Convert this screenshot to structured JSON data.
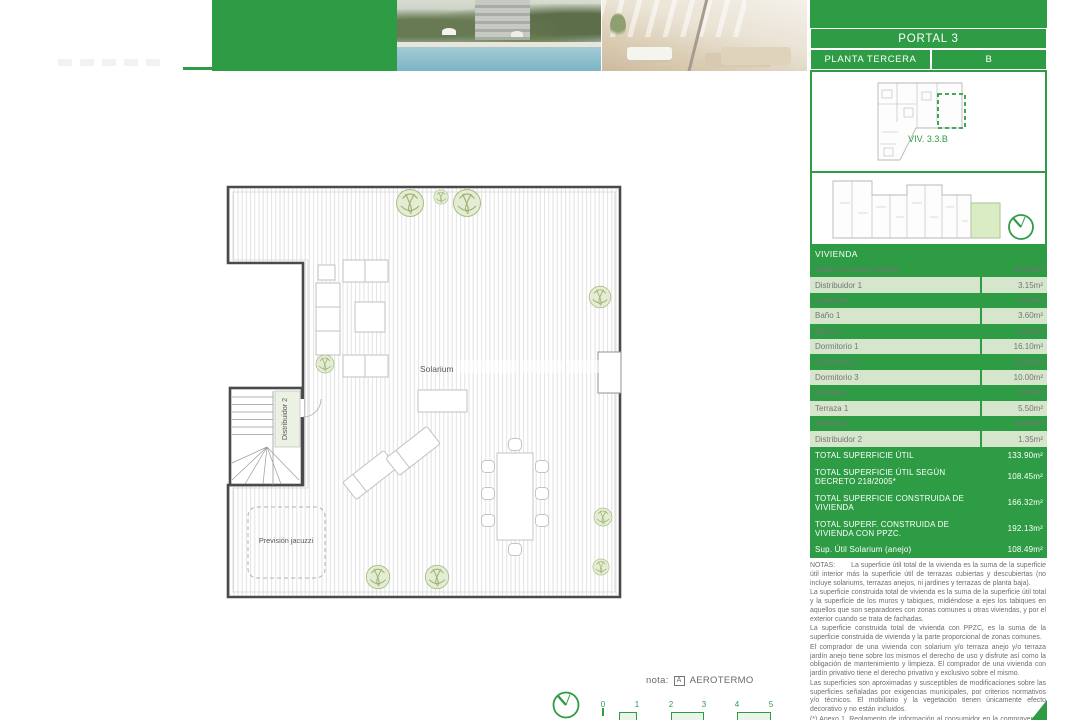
{
  "colors": {
    "green": "#2E9C45",
    "row_green": "#D6E6CC",
    "unit_highlight": "#D9ECC3"
  },
  "header": {
    "portal": "PORTAL 3",
    "floor": "PLANTA TERCERA",
    "unit": "B"
  },
  "keyplan": {
    "label": "VIV. 3.3.B"
  },
  "plan": {
    "solarium_label": "Solarium",
    "stair_label": "Distribuidor 2",
    "jacuzzi_label": "Previsión jacuzzi"
  },
  "table": {
    "header": "VIVIENDA",
    "rows": [
      {
        "name": "Salón-Comedor-Cocina",
        "value": "42.35m²"
      },
      {
        "name": "Distribuidor 1",
        "value": "3.15m²"
      },
      {
        "name": "Lavadero",
        "value": "4.45m²"
      },
      {
        "name": "Baño 1",
        "value": "3.60m²"
      },
      {
        "name": "Baño 2",
        "value": "4.30m²"
      },
      {
        "name": "Dormitorio 1",
        "value": "16.10m²"
      },
      {
        "name": "Dormitorio 2",
        "value": "10.05m²"
      },
      {
        "name": "Dormitorio 3",
        "value": "10.00m²"
      },
      {
        "name": "Escalera",
        "value": "3.00m²"
      },
      {
        "name": "Terraza 1",
        "value": "5.50m²"
      },
      {
        "name": "Terraza 2",
        "value": "30.05m²"
      },
      {
        "name": "Distribuidor 2",
        "value": "1.35m²"
      }
    ],
    "totals": [
      {
        "name": "TOTAL SUPERFICIE ÚTIL",
        "value": "133.90m²"
      },
      {
        "name": "TOTAL SUPERFICIE ÚTIL SEGÚN DECRETO 218/2005*",
        "value": "108.45m²"
      },
      {
        "name": "TOTAL SUPERFICIE CONSTRUIDA DE VIVIENDA",
        "value": "166.32m²"
      },
      {
        "name": "TOTAL SUPERF. CONSTRUIDA DE VIVIENDA CON PPZC.",
        "value": "192.13m²"
      },
      {
        "name": "Sup. Útil Solarium (anejo)",
        "value": "108.49m²"
      }
    ]
  },
  "notes": {
    "label": "NOTAS:",
    "paragraphs": [
      "La superficie útil total de la vivienda es la suma de la superficie útil interior más la superficie útil de terrazas cubiertas y descubiertas (no incluye solariums, terrazas anejos, ni jardines y terrazas de planta baja).",
      "La superficie construida total de vivienda es la suma de la superficie útil total y la superficie de los muros y tabiques, midiéndose a ejes los tabiques en aquellos que son separadores con zonas comunes u otras viviendas, y por el exterior cuando se trata de fachadas.",
      "La superficie construida total de vivienda con PPZC, es la suma de la superficie construida de vivienda y la parte proporcional de zonas comunes.",
      "El comprador de una vivienda con solarium y/o terraza anejo y/o terraza jardín anejo tiene sobre los mismos el derecho de uso y disfrute así como la obligación de mantenimiento y limpieza. El comprador de una vivienda con jardín privativo tiene el derecho privativo y exclusivo sobre el mismo.",
      "Las superficies son aproximadas y susceptibles de modificaciones sobre las superficies señaladas por exigencias municipales, por criterios normativos y/o técnicos. El mobiliario y la vegetación tienen únicamente efecto decorativo y no están incluidos.",
      "(*) Anexo 1. Reglamento de información al consumidor en la compraventa y arrendamiento de viviendas en Andalucía."
    ]
  },
  "footer": {
    "nota_label": "nota:",
    "marker": "A",
    "marker_text": "AEROTERMO",
    "scale_ticks": [
      "0",
      "1",
      "2",
      "3",
      "4",
      "5"
    ]
  }
}
